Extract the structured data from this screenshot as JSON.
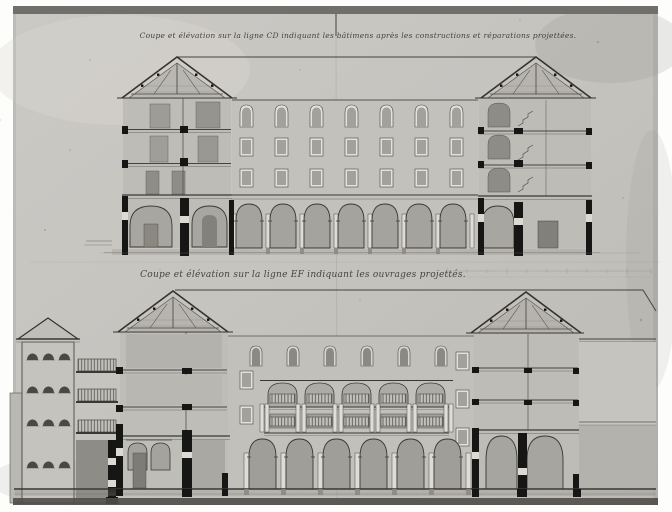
{
  "photo": {
    "description": "black-and-white photograph of an 18th-century architectural wash drawing, two cross-section / elevation studies of an arcaded building",
    "paper_color": "#c6c4bf",
    "ink_color": "#3a3836",
    "wash_wall": "#c2c0ba",
    "wash_dark": "#9e9c96",
    "poche_black": "#161614",
    "highlight": "#e3e1db"
  },
  "upper_drawing": {
    "caption": "Coupe et élévation sur la ligne CD indiquant les bâtimens après les constructions et réparations projettées.",
    "window_rows": 3,
    "window_columns": 7,
    "arcade_arches": 7,
    "pavilions": 2
  },
  "lower_drawing": {
    "caption": "Coupe et élévation sur la ligne EF indiquant les ouvrages projettés.",
    "loggia_bays": 5,
    "arcade_arches": 6,
    "attic_windows": 6,
    "tower_window_rows": 4,
    "tower_windows_per_row": 3,
    "gallery_levels": 3
  }
}
